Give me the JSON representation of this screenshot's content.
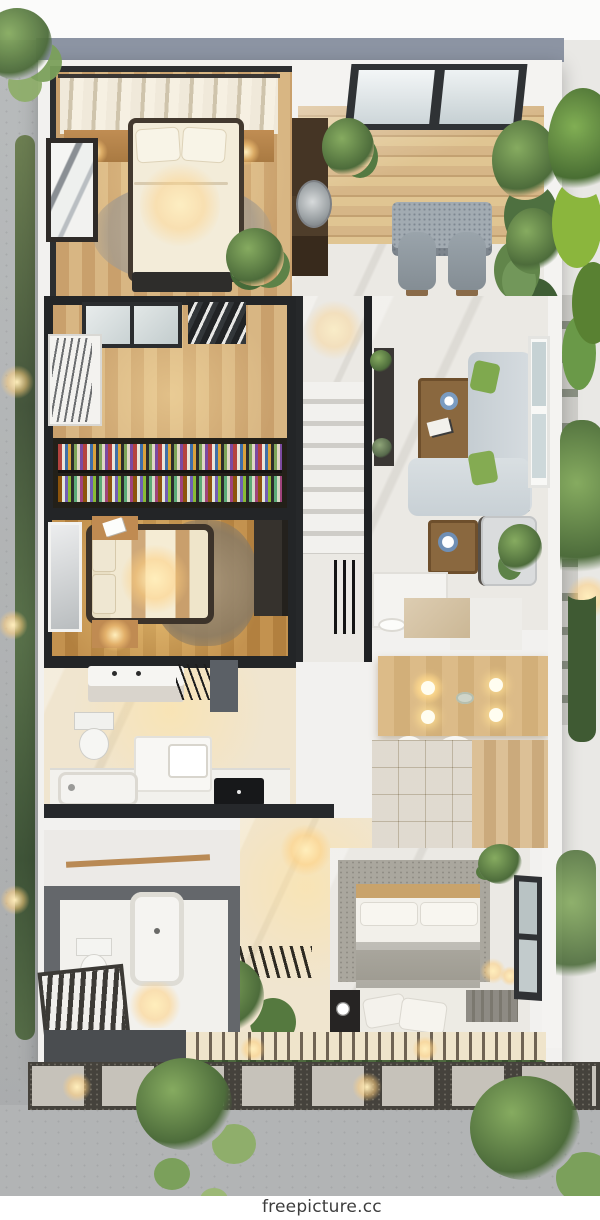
{
  "watermark": {
    "text": "freepicture.cc"
  },
  "palette": {
    "roof_band": "#8c94a3",
    "wall_dark": "#26282b",
    "wall_white": "#f4f3f1",
    "wood_light": "#d8b683",
    "wood_dark": "#c9a06c",
    "marble": "#ebe9e4",
    "sofa_gray": "#d3d9dd",
    "pillow_green": "#7fa94e",
    "bed_cream": "#f3ecd9",
    "blanket_gray": "#a3a099",
    "plant_green": "#4d6c3b",
    "concrete": "#b3b5b6",
    "warm_light": "#ffcf7e"
  }
}
